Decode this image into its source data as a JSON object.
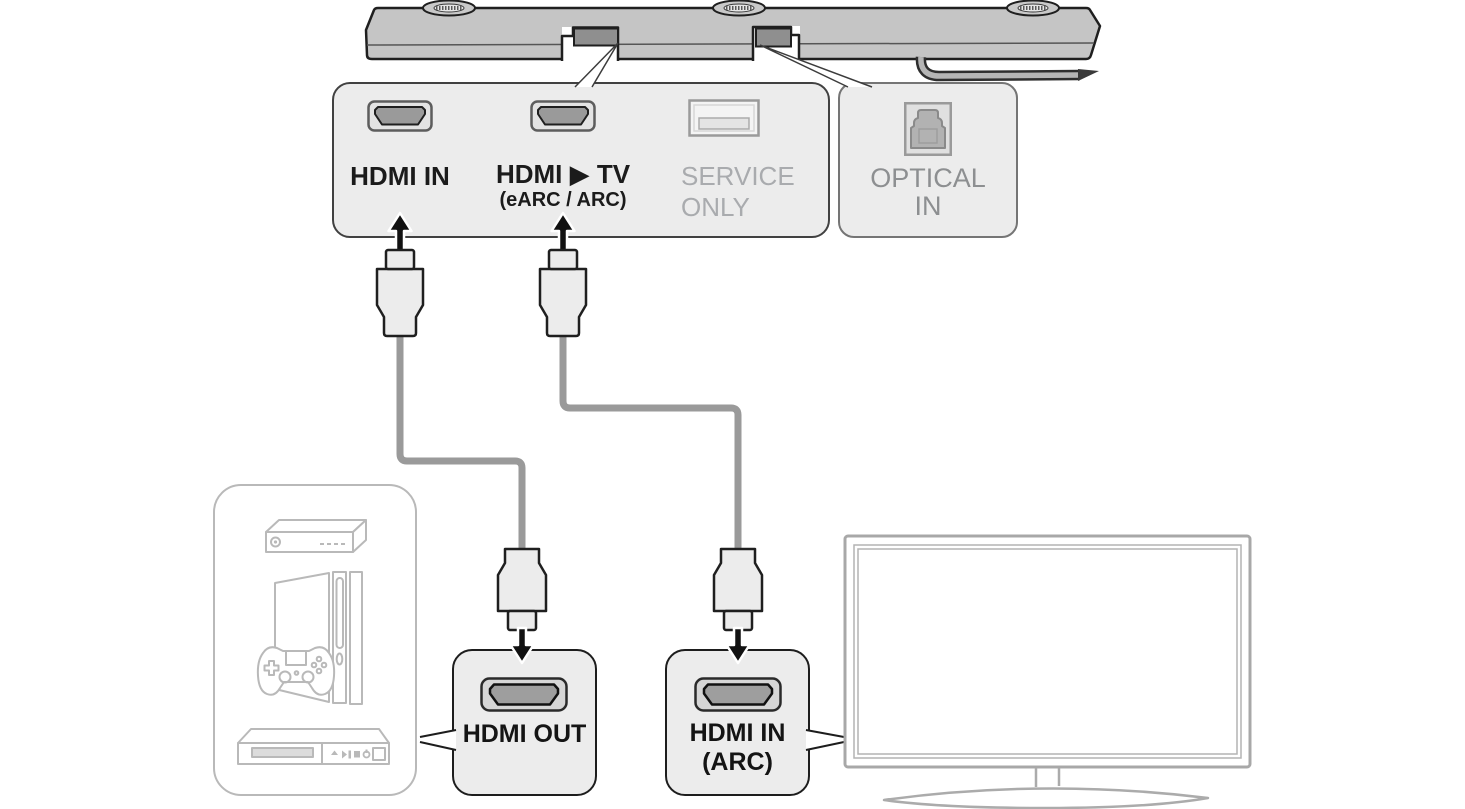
{
  "diagram": {
    "ports_panel": {
      "hdmi_in": {
        "label": "HDMI IN"
      },
      "hdmi_tv": {
        "label": "HDMI ▶ TV",
        "sublabel": "(eARC / ARC)"
      },
      "service": {
        "line1": "SERVICE",
        "line2": "ONLY"
      }
    },
    "optical_panel": {
      "line1": "OPTICAL",
      "line2": "IN"
    },
    "callouts": {
      "hdmi_out": {
        "label": "HDMI OUT"
      },
      "hdmi_in_arc": {
        "line1": "HDMI IN",
        "line2": "(ARC)"
      }
    },
    "icons": {
      "hdmi_port": "hdmi-port-icon",
      "usb_service_port": "usb-service-port-icon",
      "optical_port": "optical-port-icon",
      "arrow_up": "arrow-up-icon",
      "arrow_down": "arrow-down-icon",
      "speaker_foot": "speaker-foot-icon",
      "settop_box": "settop-box-icon",
      "game_console": "game-console-icon",
      "gamepad": "gamepad-icon",
      "bluray_player": "bluray-player-icon",
      "tv": "tv-icon"
    },
    "colors": {
      "panel_fill": "#ececec",
      "dark_outline": "#1f1f1f",
      "soundbar_fill": "#c5c5c5",
      "port_fill": "#9a9a9a",
      "cable_gray": "#9a9a9a",
      "gray_label": "#a9abae",
      "optical_label": "#8d8f91",
      "device_outline": "#b9b9b9",
      "tv_outline": "#a8a8a8"
    }
  }
}
